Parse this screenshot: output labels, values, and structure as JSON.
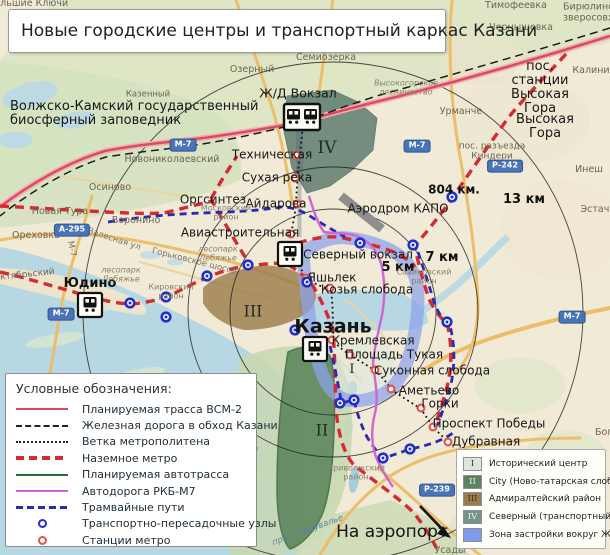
{
  "title": "Новые городские центры и транспортный каркас Казани",
  "legend_left": {
    "title": "Условные обозначения:",
    "items": [
      {
        "type": "solid",
        "color": "#dc4a5a",
        "label": "Планируемая трасса ВСМ-2"
      },
      {
        "type": "dashed",
        "color": "#222222",
        "label": "Железная дорога в обход Казани"
      },
      {
        "type": "dotted",
        "color": "#222222",
        "label": "Ветка метрополитена"
      },
      {
        "type": "thickdash",
        "color": "#d62a30",
        "label": "Наземное метро"
      },
      {
        "type": "solid",
        "color": "#2a6b35",
        "label": "Планируемая автотрасса"
      },
      {
        "type": "solid",
        "color": "#d063d6",
        "label": "Автодорога РКБ-М7"
      },
      {
        "type": "meddash",
        "color": "#2a2ab4",
        "label": "Трамвайные пути"
      },
      {
        "type": "dot",
        "color": "#2230c8",
        "label": "Транспортно-пересадочные узлы"
      },
      {
        "type": "dot",
        "color": "#e2574c",
        "label": "Станции метро"
      }
    ]
  },
  "legend_right": {
    "items": [
      {
        "numeral": "I",
        "color": "#dce6da",
        "numeral_color": "#333333",
        "label": "Исторический центр"
      },
      {
        "numeral": "II",
        "color": "#5c8163",
        "numeral_color": "#eef2ee",
        "label": "City (Ново-татарская слобода)"
      },
      {
        "numeral": "III",
        "color": "#9c7c4c",
        "numeral_color": "#3a3222",
        "label": "Адмиралтейский район"
      },
      {
        "numeral": "IV",
        "color": "#78938a",
        "numeral_color": "#eef2ee",
        "label": "Северный (транспортный) центр"
      },
      {
        "numeral": "",
        "color": "#7f9bee",
        "numeral_color": "#7f9bee",
        "label": "Зона застройки вокруг ЖД кольца"
      }
    ]
  },
  "map": {
    "colors": {
      "vsm2": "#dc4a5a",
      "bypass_rail": "#1c1c1c",
      "metro_line": "#111111",
      "ground_metro": "#d62a30",
      "autotrassa": "#2a6b35",
      "rkb_m7": "#d063d6",
      "tram": "#2a2ab4",
      "transit_node": "#2230c8",
      "metro_station": "#e2574c",
      "ring_zone": "#8ca2ec",
      "water": "#b7d7e2",
      "forest": "#d5e2bf"
    },
    "rings": {
      "cx": 333,
      "cy": 312,
      "radii": [
        103,
        145,
        250
      ]
    },
    "labels": [
      [
        "Волжско-Камский государственный\nбиосферный заповедник",
        10,
        114,
        "major-left",
        0,
        13
      ],
      [
        "Ж/Д Вокзал",
        298,
        93,
        "major",
        0,
        12.5
      ],
      [
        "Техническая",
        272,
        155,
        "major",
        0,
        0
      ],
      [
        "Сухая река",
        277,
        178,
        "major",
        0,
        0
      ],
      [
        "Оргсинтез",
        213,
        200,
        "major",
        0,
        0
      ],
      [
        "Айдарова",
        276,
        204,
        "major",
        0,
        0
      ],
      [
        "Авиастроительная",
        240,
        233,
        "major",
        0,
        0
      ],
      [
        "Юдино",
        90,
        284,
        "major-bold",
        0,
        0
      ],
      [
        "Северный вокзал",
        358,
        255,
        "major",
        0,
        0
      ],
      [
        "Яшьлек",
        332,
        278,
        "major",
        0,
        0
      ],
      [
        "Козья слобода",
        367,
        290,
        "major",
        0,
        0
      ],
      [
        "Кремлевская",
        373,
        341,
        "major",
        0,
        0
      ],
      [
        "Площадь Тукая",
        394,
        355,
        "major",
        0,
        0
      ],
      [
        "Суконная слобода",
        432,
        371,
        "major",
        0,
        0
      ],
      [
        "Аметьево",
        429,
        391,
        "major",
        0,
        0
      ],
      [
        "Горки",
        440,
        404,
        "major",
        0,
        0
      ],
      [
        "Проспект Победы",
        489,
        424,
        "major",
        0,
        0
      ],
      [
        "Дубравная",
        486,
        442,
        "major",
        0,
        0
      ],
      [
        "Аэродром КАПО",
        398,
        209,
        "major",
        0,
        0
      ],
      [
        "пос. станции Высокая Гора",
        540,
        88,
        "major",
        0,
        13
      ],
      [
        "Высокая Гора",
        545,
        127,
        "major",
        0,
        13
      ],
      [
        "Казань",
        333,
        327,
        "big",
        0,
        0
      ],
      [
        "На аэропорт",
        392,
        532,
        "big2",
        0,
        0
      ],
      [
        "804 км.",
        454,
        190,
        "dist",
        0,
        12
      ],
      [
        "13 км",
        524,
        200,
        "dist",
        0,
        0
      ],
      [
        "7 км",
        442,
        258,
        "dist",
        0,
        0
      ],
      [
        "5 км",
        398,
        268,
        "dist",
        0,
        0
      ],
      [
        "IV",
        327,
        148,
        "roman",
        0,
        17
      ],
      [
        "III",
        253,
        311,
        "roman",
        0,
        16
      ],
      [
        "I",
        352,
        370,
        "roman",
        0,
        13
      ],
      [
        "II",
        322,
        430,
        "roman",
        0,
        16
      ],
      [
        "Большие Ключи",
        28,
        4,
        "town",
        0,
        0
      ],
      [
        "Тимофеевка",
        516,
        6,
        "town",
        0,
        0
      ],
      [
        "Чернышевка",
        521,
        28,
        "town",
        0,
        0
      ],
      [
        "Калинино",
        597,
        71,
        "town",
        0,
        0
      ],
      [
        "Семиозерка",
        326,
        58,
        "town",
        0,
        0
      ],
      [
        "Озерный",
        252,
        70,
        "town",
        0,
        0
      ],
      [
        "Урманче",
        461,
        112,
        "town",
        0,
        0
      ],
      [
        "Инеш",
        589,
        170,
        "town",
        0,
        0
      ],
      [
        "Эстачи",
        598,
        210,
        "town",
        0,
        0
      ],
      [
        "Новониколаевский",
        172,
        160,
        "town",
        0,
        0
      ],
      [
        "Осиново",
        110,
        188,
        "town",
        0,
        0
      ],
      [
        "Новая Тура",
        60,
        212,
        "town",
        0,
        0
      ],
      [
        "Ореховка",
        36,
        236,
        "town",
        0,
        0
      ],
      [
        "Воронино",
        136,
        221,
        "town",
        0,
        0
      ],
      [
        "Казенный",
        148,
        95,
        "town",
        0,
        8.5
      ],
      [
        "пос. разъезда\nКиндери",
        492,
        152,
        "town",
        0,
        9
      ],
      [
        "пос. Бирюлинского\nзверосовхоза",
        563,
        8,
        "town-left",
        0,
        9.5
      ],
      [
        "Усады",
        450,
        551,
        "town",
        0,
        0
      ],
      [
        "Богородское",
        595,
        433,
        "town-left",
        0,
        0
      ],
      [
        "Октябрьский",
        24,
        276,
        "town",
        -6,
        9
      ],
      [
        "Московский\nрайон",
        226,
        213,
        "small",
        0,
        0
      ],
      [
        "Кировский\nрайон",
        171,
        292,
        "small",
        0,
        0
      ],
      [
        "Савиновский\nрайон",
        424,
        277,
        "small",
        0,
        0
      ],
      [
        "Приволжский\nрайон",
        356,
        473,
        "small",
        0,
        0
      ],
      [
        "Высокогорское\nлесничество",
        406,
        88,
        "forest",
        0,
        0
      ],
      [
        "лесопарк\nЛебяжье",
        218,
        254,
        "forest",
        0,
        0
      ],
      [
        "лесопарк\nЛебяжье",
        121,
        275,
        "forest",
        0,
        0
      ],
      [
        "Залесная ул",
        114,
        240,
        "roadname",
        18,
        0
      ],
      [
        "Горьковское шоссе",
        194,
        262,
        "roadname",
        14,
        0
      ],
      [
        "М-7",
        71,
        249,
        "roadname",
        78,
        0
      ],
      [
        "р. Волга",
        253,
        464,
        "water",
        -78,
        0
      ],
      [
        "прот. Подувалье",
        308,
        531,
        "water",
        -20,
        0
      ]
    ],
    "badges": [
      [
        "М-7",
        183,
        145
      ],
      [
        "М-7",
        417,
        146
      ],
      [
        "М-7",
        61,
        314
      ],
      [
        "М-7",
        572,
        317
      ],
      [
        "А-295",
        72,
        230
      ],
      [
        "Р-242",
        505,
        166
      ],
      [
        "Р-239",
        437,
        490
      ]
    ],
    "transit_nodes": [
      [
        130,
        303
      ],
      [
        166,
        297
      ],
      [
        166,
        317
      ],
      [
        207,
        276
      ],
      [
        248,
        265
      ],
      [
        295,
        330
      ],
      [
        307,
        282
      ],
      [
        360,
        243
      ],
      [
        413,
        245
      ],
      [
        452,
        197
      ],
      [
        447,
        322
      ],
      [
        340,
        403
      ],
      [
        354,
        400
      ],
      [
        383,
        458
      ],
      [
        410,
        449
      ]
    ],
    "metro_stations": [
      [
        296,
        155
      ],
      [
        295,
        178
      ],
      [
        297,
        204
      ],
      [
        291,
        234
      ],
      [
        306,
        278
      ],
      [
        330,
        288
      ],
      [
        332,
        340
      ],
      [
        350,
        355
      ],
      [
        375,
        370
      ],
      [
        391,
        389
      ],
      [
        421,
        408
      ],
      [
        433,
        427
      ],
      [
        448,
        442
      ]
    ],
    "stations": [
      {
        "name": "zhd-vokzal",
        "x": 302,
        "y": 117,
        "double": true
      },
      {
        "name": "severny-vokzal",
        "x": 290,
        "y": 254,
        "double": false
      },
      {
        "name": "yudino",
        "x": 90,
        "y": 305,
        "double": false
      },
      {
        "name": "kazan",
        "x": 315,
        "y": 349,
        "double": false
      }
    ]
  }
}
